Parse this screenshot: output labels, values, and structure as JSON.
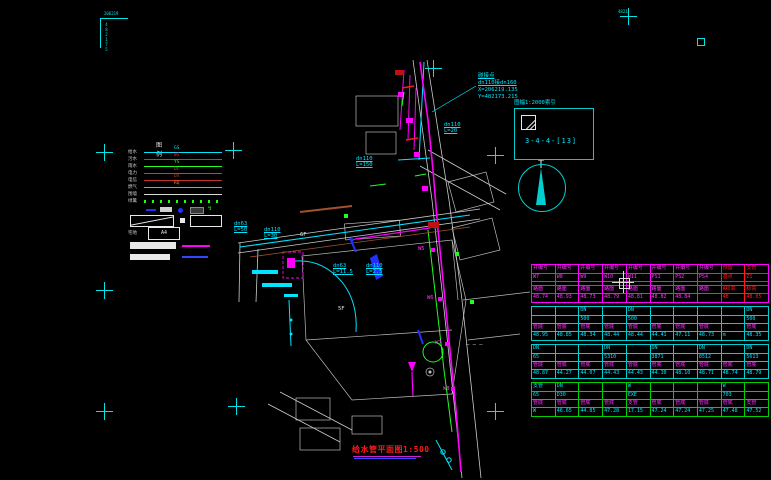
{
  "title": {
    "text": "给水管平面图1:500"
  },
  "corner_marks": {
    "top_left_h": "206219",
    "top_left_v": "482175",
    "top_right": "4821"
  },
  "callout": {
    "lines": [
      "碰接点",
      "dn110接dn160",
      "X=206219.135",
      "Y=482173.215"
    ]
  },
  "index_box": {
    "caption": "图幅1:2000索引",
    "code": "3-4-4-[13]"
  },
  "legend": {
    "title": "图 例",
    "rows": [
      {
        "label": "给水",
        "code": "GS",
        "color": "#00e5ff",
        "style": "solid"
      },
      {
        "label": "污水",
        "code": "WS",
        "color": "#ff2020",
        "style": "solid"
      },
      {
        "label": "雨水",
        "code": "YS",
        "color": "#20ff20",
        "style": "solid"
      },
      {
        "label": "电力",
        "code": "DL",
        "color": "#a0522d",
        "style": "solid"
      },
      {
        "label": "电信",
        "code": "DX",
        "color": "#c03030",
        "style": "solid"
      },
      {
        "label": "燃气",
        "code": "RQ",
        "color": "#ff8c00",
        "style": "solid"
      },
      {
        "label": "围墙",
        "code": "",
        "color": "#d8d8d8",
        "style": "solid"
      },
      {
        "label": "绿篱",
        "code": "",
        "color": "#20ff20",
        "style": "dotted"
      }
    ],
    "plot_box_label": "宅地",
    "plot_box_code": "A4"
  },
  "map": {
    "labels": [
      {
        "x": 444,
        "y": 122,
        "lines": [
          "dn110",
          "L=20"
        ],
        "color": "#00e5ff",
        "underline": true
      },
      {
        "x": 356,
        "y": 156,
        "lines": [
          "dn110",
          "L=150"
        ],
        "color": "#00e5ff",
        "underline": true
      },
      {
        "x": 234,
        "y": 221,
        "lines": [
          "dn63",
          "L=50"
        ],
        "color": "#00e5ff",
        "underline": true
      },
      {
        "x": 264,
        "y": 227,
        "lines": [
          "dn110",
          "L=30"
        ],
        "color": "#00e5ff",
        "underline": true
      },
      {
        "x": 333,
        "y": 263,
        "lines": [
          "dn63",
          "L=11.5"
        ],
        "color": "#00e5ff",
        "underline": true
      },
      {
        "x": 366,
        "y": 263,
        "lines": [
          "dn110",
          "L=2.5"
        ],
        "color": "#00e5ff",
        "underline": true
      },
      {
        "x": 418,
        "y": 246,
        "lines": [
          "W5"
        ],
        "color": "#ff30ff",
        "underline": false
      },
      {
        "x": 427,
        "y": 295,
        "lines": [
          "W6"
        ],
        "color": "#ff30ff",
        "underline": false
      },
      {
        "x": 435,
        "y": 340,
        "lines": [
          "W7"
        ],
        "color": "#ff30ff",
        "underline": false
      },
      {
        "x": 443,
        "y": 386,
        "lines": [
          "W8"
        ],
        "color": "#ff30ff",
        "underline": false
      },
      {
        "x": 466,
        "y": 342,
        "lines": [
          "— — —"
        ],
        "color": "#e8e8e8",
        "underline": false
      },
      {
        "x": 300,
        "y": 232,
        "lines": [
          "6F"
        ],
        "color": "#e8e8e8",
        "underline": false
      },
      {
        "x": 338,
        "y": 306,
        "lines": [
          "5F"
        ],
        "color": "#e8e8e8",
        "underline": false
      }
    ]
  },
  "table": {
    "sections": [
      {
        "stroke": "#ff00ff",
        "red_from": 8,
        "red_color": "#ff1a1a",
        "rows": [
          {
            "h": 8,
            "color": "#ff30ff",
            "cells": [
              "井编号",
              "井编号",
              "井编号",
              "井编号",
              "井编号",
              "井编号",
              "井编号",
              "井编号",
              "预留",
              "支管"
            ]
          },
          {
            "h": 8,
            "color": "#ff30ff",
            "cells": [
              "W7",
              "W8",
              "W9",
              "W10",
              "W11",
              "PS1",
              "PS2",
              "PS4",
              "基点",
              "Z1"
            ]
          },
          {
            "h": 4,
            "color": "#ff30ff",
            "cells": [
              "",
              "",
              "",
              "",
              "",
              "",
              "",
              "",
              "",
              ""
            ]
          },
          {
            "h": 8,
            "color": "#ff30ff",
            "cells": [
              "路面",
              "路面",
              "路面",
              "路面",
              "路面",
              "路面",
              "路面",
              "路面",
              "A标高",
              "标高"
            ]
          },
          {
            "h": 9,
            "color": "#ff30ff",
            "cells": [
              "48.74",
              "48.93",
              "48.73",
              "48.79",
              "48.81",
              "48.82",
              "48.84",
              "",
              "48",
              "48.05"
            ]
          }
        ]
      },
      {
        "stroke": "#00cfcf",
        "red_from": -1,
        "red_color": "",
        "rows": [
          {
            "h": 8,
            "color": "#00e5ff",
            "cells": [
              "",
              "",
              "DN",
              "",
              "DN",
              "",
              "",
              "",
              "",
              "DN"
            ]
          },
          {
            "h": 8,
            "color": "#00e5ff",
            "cells": [
              "",
              "",
              "500",
              "",
              "500",
              "",
              "",
              "",
              "",
              "500"
            ]
          },
          {
            "h": 8,
            "color": "#ff30ff",
            "cells": [
              "管底",
              "管底",
              "管底",
              "管底",
              "管底",
              "管底",
              "管底",
              "管底",
              "",
              "管底"
            ]
          },
          {
            "h": 9,
            "color": "#00e5ff",
            "cells": [
              "48.95",
              "48.85",
              "48.34",
              "48.44",
              "48.44",
              "44.41",
              "47.11",
              "48.73",
              "m",
              "48.35"
            ]
          }
        ]
      },
      {
        "stroke": "#00cfcf",
        "red_from": -1,
        "red_color": "",
        "rows": [
          {
            "h": 8,
            "color": "#00e5ff",
            "cells": [
              "DN",
              "",
              "",
              "DN",
              "",
              "DN",
              "",
              "DN",
              "",
              "DN"
            ]
          },
          {
            "h": 8,
            "color": "#00e5ff",
            "cells": [
              "65",
              "",
              "",
              "5310",
              "",
              "3871",
              "",
              "8512",
              "",
              "5613"
            ]
          },
          {
            "h": 8,
            "color": "#ff30ff",
            "cells": [
              "管底",
              "管底",
              "管底",
              "管底",
              "管底",
              "管底",
              "管底",
              "管底",
              "管底",
              "管底"
            ]
          },
          {
            "h": 9,
            "color": "#00e5ff",
            "cells": [
              "48.87",
              "44.27",
              "44.07",
              "44.43",
              "44.43",
              "44.10",
              "48.10",
              "48.71",
              "48.74",
              "48.79"
            ]
          }
        ]
      },
      {
        "stroke": "#00cf00",
        "red_from": -1,
        "red_color": "",
        "rows": [
          {
            "h": 8,
            "color": "#00e5ff",
            "cells": [
              "支管",
              "DN",
              "",
              "",
              "W",
              "",
              "",
              "",
              "W",
              ""
            ]
          },
          {
            "h": 8,
            "color": "#00e5ff",
            "cells": [
              "65",
              "D30",
              "",
              "",
              "EXE",
              "",
              "",
              "",
              "703",
              ""
            ]
          },
          {
            "h": 8,
            "color": "#ff30ff",
            "cells": [
              "管底",
              "管底",
              "管底",
              "管底",
              "支管",
              "管底",
              "管底",
              "管底",
              "管底",
              "支管"
            ]
          },
          {
            "h": 9,
            "color": "#00e5ff",
            "cells": [
              "W",
              "46.65",
              "44.85",
              "47.28",
              "17.15",
              "47.24",
              "47.24",
              "47.25",
              "47.48",
              "47.52"
            ]
          }
        ]
      }
    ]
  },
  "crosses": [
    {
      "x": 433,
      "y": 68
    },
    {
      "x": 628,
      "y": 16
    },
    {
      "x": 104,
      "y": 152
    },
    {
      "x": 233,
      "y": 150
    },
    {
      "x": 495,
      "y": 155
    },
    {
      "x": 104,
      "y": 290
    },
    {
      "x": 104,
      "y": 411
    },
    {
      "x": 236,
      "y": 406
    },
    {
      "x": 495,
      "y": 411
    }
  ],
  "colors": {
    "water_new": "#ff00ff",
    "water_exist": "#00e5ff",
    "green_line": "#20ff20",
    "road": "#d8d8d8",
    "accent_red": "#ff1a1a"
  }
}
